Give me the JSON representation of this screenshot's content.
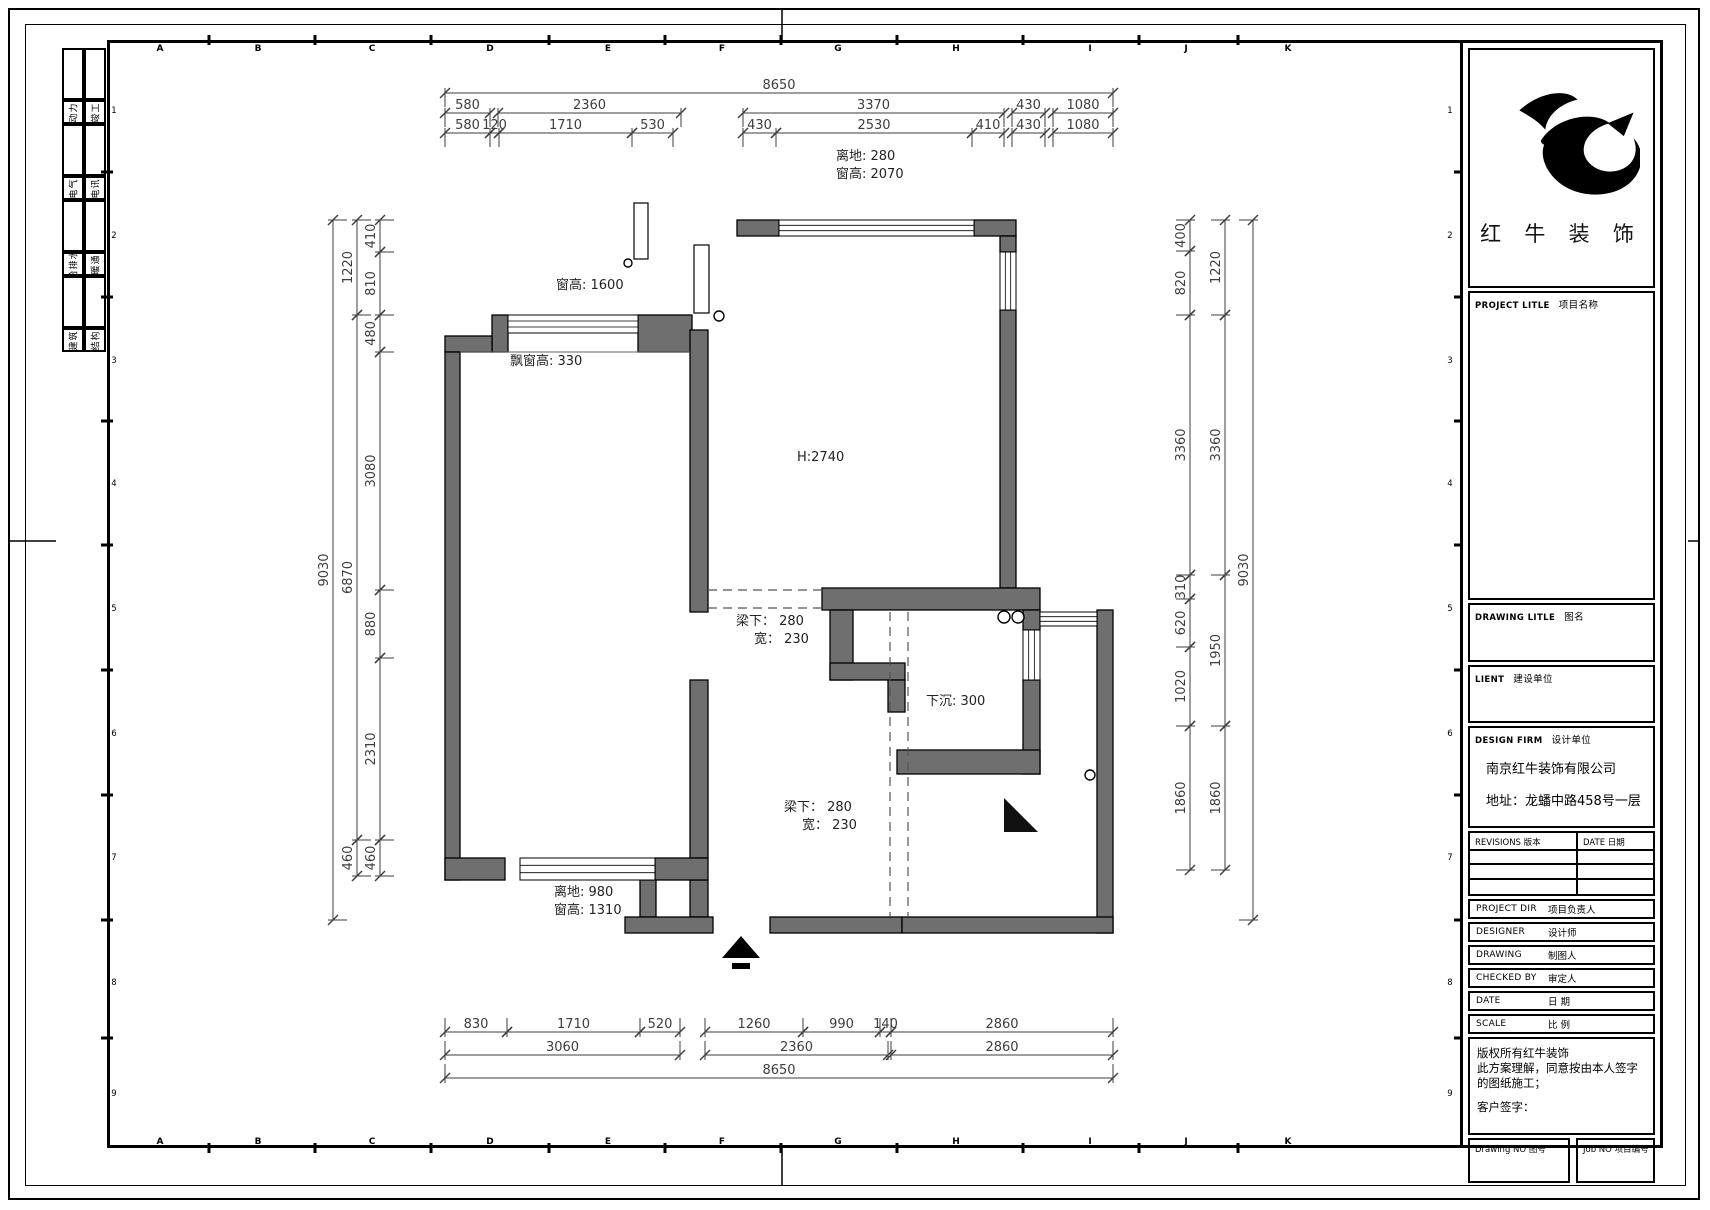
{
  "sheet": {
    "grid_letters": [
      "A",
      "B",
      "C",
      "D",
      "E",
      "F",
      "G",
      "H",
      "I",
      "J",
      "K"
    ],
    "row_numbers": [
      "1",
      "2",
      "3",
      "4",
      "5",
      "6",
      "7",
      "8",
      "9"
    ],
    "line_color": "#000000",
    "wall_color": "#6f6f6f"
  },
  "disciplines": {
    "col1": [
      "动力",
      "电气",
      "给排水",
      "建筑"
    ],
    "col2": [
      "竣工",
      "电讯",
      "暖通",
      "结构"
    ]
  },
  "plan": {
    "labels": [
      {
        "id": "top-window-offset",
        "text": "离地: 280"
      },
      {
        "id": "top-window-height",
        "text": "窗高: 2070"
      },
      {
        "id": "left-window-height",
        "text": "窗高: 1600"
      },
      {
        "id": "bay-window-height",
        "text": "飘窗高: 330"
      },
      {
        "id": "ceiling-height",
        "text": "H:2740"
      },
      {
        "id": "beam1-line1",
        "text": "梁下： 280"
      },
      {
        "id": "beam1-line2",
        "text": "宽： 230"
      },
      {
        "id": "sunken-floor",
        "text": "下沉: 300"
      },
      {
        "id": "beam2-line1",
        "text": "梁下： 280"
      },
      {
        "id": "beam2-line2",
        "text": "宽： 230"
      },
      {
        "id": "bottom-window-offset",
        "text": "离地: 980"
      },
      {
        "id": "bottom-window-height",
        "text": "窗高: 1310"
      }
    ],
    "dims": {
      "top": [
        [
          "8650"
        ],
        [
          "580",
          "2360",
          "3370",
          "430",
          "1080"
        ],
        [
          "580",
          "120",
          "1710",
          "530",
          "430",
          "2530",
          "410",
          "430",
          "1080"
        ]
      ],
      "bottom": [
        [
          "830",
          "1710",
          "520",
          "1260",
          "990",
          "140",
          "2860"
        ],
        [
          "3060",
          "2360",
          "2860"
        ],
        [
          "8650"
        ]
      ],
      "left": [
        [
          "9030"
        ],
        [
          "1220",
          "6870",
          "460"
        ],
        [
          "410",
          "810",
          "480",
          "3080",
          "880",
          "2310",
          "460"
        ]
      ],
      "right": [
        [
          "400",
          "820",
          "3360",
          "310",
          "620",
          "1020",
          "1860"
        ],
        [
          "1220",
          "3360",
          "1950",
          "1860"
        ],
        [
          "9030"
        ]
      ]
    }
  },
  "title_block": {
    "brand": "红 牛 装 饰",
    "project": {
      "en": "PROJECT LITLE",
      "cn": "项目名称"
    },
    "drawing_title": {
      "en": "DRAWING LITLE",
      "cn": "图名"
    },
    "client": {
      "en": "LIENT",
      "cn": "建设单位"
    },
    "design_firm": {
      "en": "DESIGN FIRM",
      "cn": "设计单位"
    },
    "firm_name": "南京红牛装饰有限公司",
    "firm_address": "地址：龙蟠中路458号一层",
    "firm_phone": "电话：025-52228155",
    "revisions": {
      "en": "REVISIONS",
      "cn": "版本"
    },
    "date_col": {
      "en": "DATE",
      "cn": "日期"
    },
    "project_dir": {
      "en": "PROJECT DIR",
      "cn": "项目负责人"
    },
    "designer": {
      "en": "DESIGNER",
      "cn": "设计师"
    },
    "drawing_by": {
      "en": "DRAWING",
      "cn": "制图人"
    },
    "checked_by": {
      "en": "CHECKED BY",
      "cn": "审定人"
    },
    "date_row": {
      "en": "DATE",
      "cn": "日  期"
    },
    "scale_row": {
      "en": "SCALE",
      "cn": "比  例"
    },
    "copyright_1": "版权所有红牛装饰",
    "copyright_2": "此方案理解，同意按由本人签字的图纸施工；",
    "copyright_3": "客户签字：",
    "drawing_no": {
      "en": "Drawing NO",
      "cn": "图号"
    },
    "job_no": {
      "en": "Job NO",
      "cn": "项目编号"
    }
  }
}
